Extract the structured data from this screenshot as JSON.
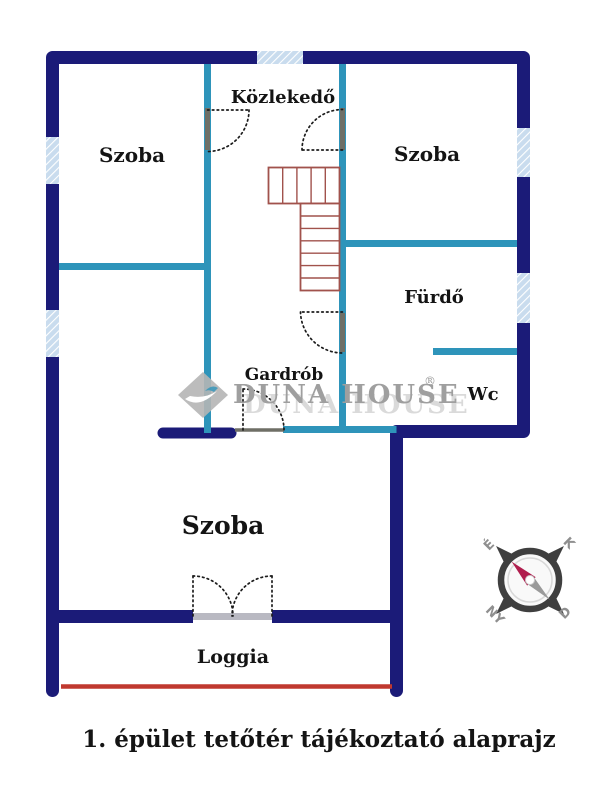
{
  "floorplan": {
    "rooms": [
      {
        "id": "szoba-top-left",
        "label": "Szoba"
      },
      {
        "id": "kozlekedo",
        "label": "Közlekedő"
      },
      {
        "id": "szoba-top-right",
        "label": "Szoba"
      },
      {
        "id": "furdo",
        "label": "Fürdő"
      },
      {
        "id": "gardrob",
        "label": "Gardrób"
      },
      {
        "id": "wc",
        "label": "Wc"
      },
      {
        "id": "szoba-bottom",
        "label": "Szoba"
      },
      {
        "id": "loggia",
        "label": "Loggia"
      }
    ],
    "caption": "1. épület tetőtér tájékoztató alaprajz"
  },
  "watermark": {
    "brand": "DUNA HOUSE",
    "registered": "®"
  },
  "compass": {
    "north": "É",
    "east": "K",
    "south": "D",
    "west": "NY"
  },
  "colors": {
    "background": "#ffffff",
    "wall_navy": "#1b1b78",
    "wall_teal": "#2e94ba",
    "window_fill": "#c9dcee",
    "window_stripe": "#ffffff",
    "stair_outline": "#a1524c",
    "loggia_edge_red": "#c0392f",
    "door_leaf_grey": "#6f6f66",
    "door_arc_black": "#1c1c1c",
    "label_black": "#141414",
    "watermark_grey": "#9f9f9f",
    "watermark_light": "#d2d2d2",
    "compass_dark": "#3f3f3f",
    "compass_needle_red": "#b01e4e",
    "compass_needle_grey": "#9a9a9a",
    "compass_letter_grey": "#8f8f8f"
  }
}
